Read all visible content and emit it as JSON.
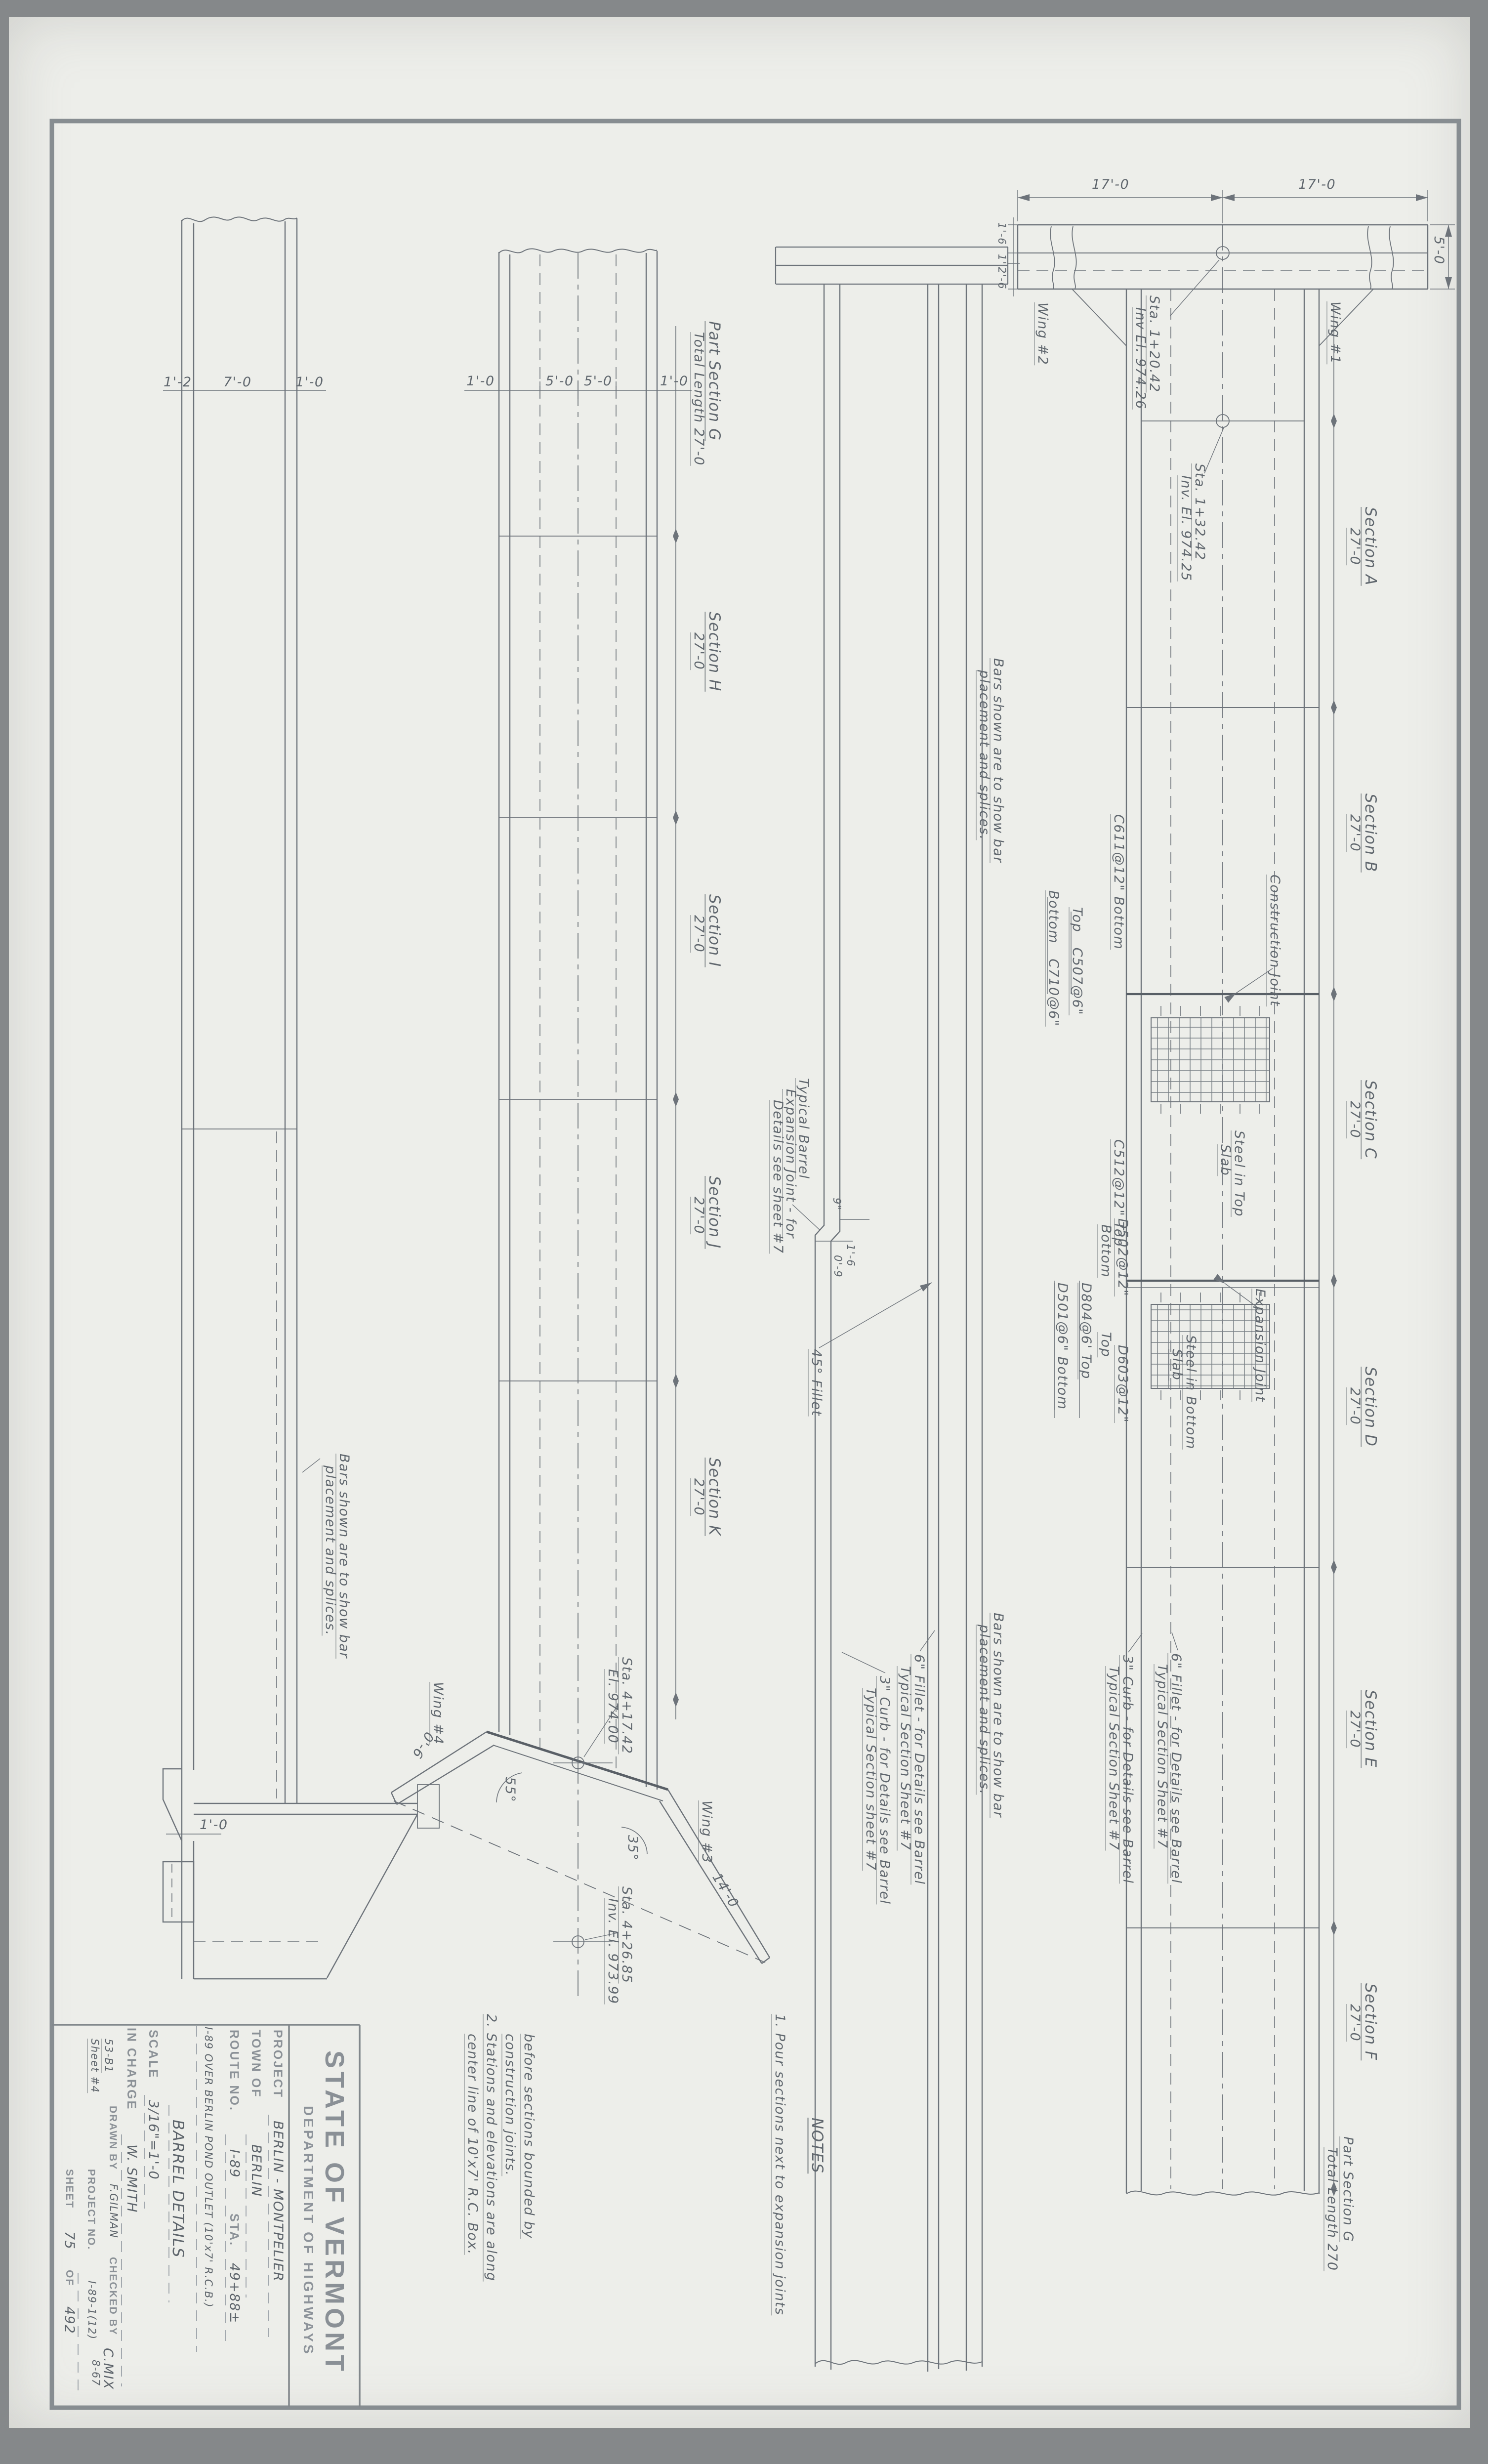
{
  "titleblock": {
    "agency": "STATE OF VERMONT",
    "department": "DEPARTMENT OF HIGHWAYS",
    "project_label": "PROJECT",
    "project": "BERLIN - MONTPELIER",
    "town_label": "TOWN OF",
    "town": "BERLIN",
    "route_label": "ROUTE NO.",
    "route": "I-89",
    "sta_label": "STA.",
    "sta": "49+88±",
    "feature": "I-89 OVER BERLIN POND OUTLET (10'x7' R.C.B.)",
    "drawing_title": "BARREL DETAILS",
    "scale_label": "SCALE",
    "scale": "3/16\"=1'-0",
    "charge_label": "IN CHARGE",
    "charge": "W. SMITH",
    "drawn_label": "DRAWN BY",
    "drawn": "F.GILMAN",
    "checked_label": "CHECKED BY",
    "checked": "C.MIX",
    "check_date": "8-67",
    "projno_label": "PROJECT NO.",
    "projno": "I-89-1(12)",
    "sheet_label": "SHEET",
    "sheet_no": "75",
    "of_label": "OF",
    "sheets_total": "492",
    "file_no": "53-B1",
    "sheet_ref": "Sheet #4"
  },
  "notes": {
    "title": "NOTES",
    "n1a": "1. Pour sections next to expansion joints",
    "n1b": "before sections bounded by",
    "n1c": "construction joints.",
    "n2a": "2. Stations and elevations are along",
    "n2b": "center line of 10'x7' R.C. Box."
  },
  "shared": {
    "dim27": "27'-0",
    "bars1": "Bars shown are to show bar",
    "bars2": "placement and splices.",
    "fillet6": "6\" Fillet - for Details see Barrel",
    "curb3": "3\" Curb - for Details see Barrel",
    "typsec7": "Typical Section Sheet #7",
    "typsec7b": "Typical Section sheet #7"
  },
  "strip1": {
    "d1": "1'-2",
    "d2": "7'-0",
    "d3": "1'-0",
    "wing_dim": "1'-0"
  },
  "strip2": {
    "d1": "1'-0",
    "d2": "5'-0",
    "d3": "5'-0",
    "d4": "1'-0",
    "partg1": "Part Section G",
    "partg2": "Total Length 27'-0",
    "sec_h": "Section H",
    "sec_i": "Section I",
    "sec_j": "Section J",
    "sec_k": "Section K",
    "wing4": "Wing #4",
    "wing3": "Wing #3",
    "a55": "55°",
    "a35": "35°",
    "d06": "0'-6",
    "d140": "14'-0",
    "sta1a": "Sta. 4+17.42",
    "sta1b": "El. 974.00",
    "sta2a": "Sta. 4+26.85",
    "sta2b": "Inv. El. 973.99"
  },
  "strip3": {
    "tb1": "Typical Barrel",
    "tb2": "Expansion Joint - for",
    "tb3": "Details see sheet #7",
    "d9": "9\"",
    "d16": "1'-6",
    "d09": "0'-9",
    "fillet45": "45° Fillet"
  },
  "strip4": {
    "d17": "17'-0",
    "d50": "5'-0",
    "d16": "1'-6",
    "d1": "1'",
    "d26": "2'-6",
    "wing2": "Wing #2",
    "wing1": "Wing #1",
    "sta1a": "Sta. 1+20.42",
    "sta1b": "Inv El. 974.26",
    "sta2a": "Sta. 1+32.42",
    "sta2b": "Inv. El. 974.25",
    "sec_a": "Section A",
    "sec_b": "Section B",
    "sec_c": "Section C",
    "sec_d": "Section D",
    "sec_e": "Section E",
    "sec_f": "Section F",
    "partg1": "Part Section G",
    "partg2": "Total Length 270",
    "cj": "Construction Joint",
    "ej": "Expansion Joint",
    "c611": "C611@12\" Bottom",
    "c710": "Bottom   C710@6\"",
    "c507": "Top   C507@6\"",
    "c512": "C512@12\" Top",
    "d502a": "Bottom",
    "d502b": "D502@12\"",
    "d501": "D501@6\" Bottom",
    "d804": "D804@6' Top",
    "d603a": "Top",
    "d603b": "D603@12\"",
    "sit1": "Steel in Top",
    "sit2": "Slab",
    "sib1": "Steel in Bottom",
    "sib2": "Slab"
  }
}
